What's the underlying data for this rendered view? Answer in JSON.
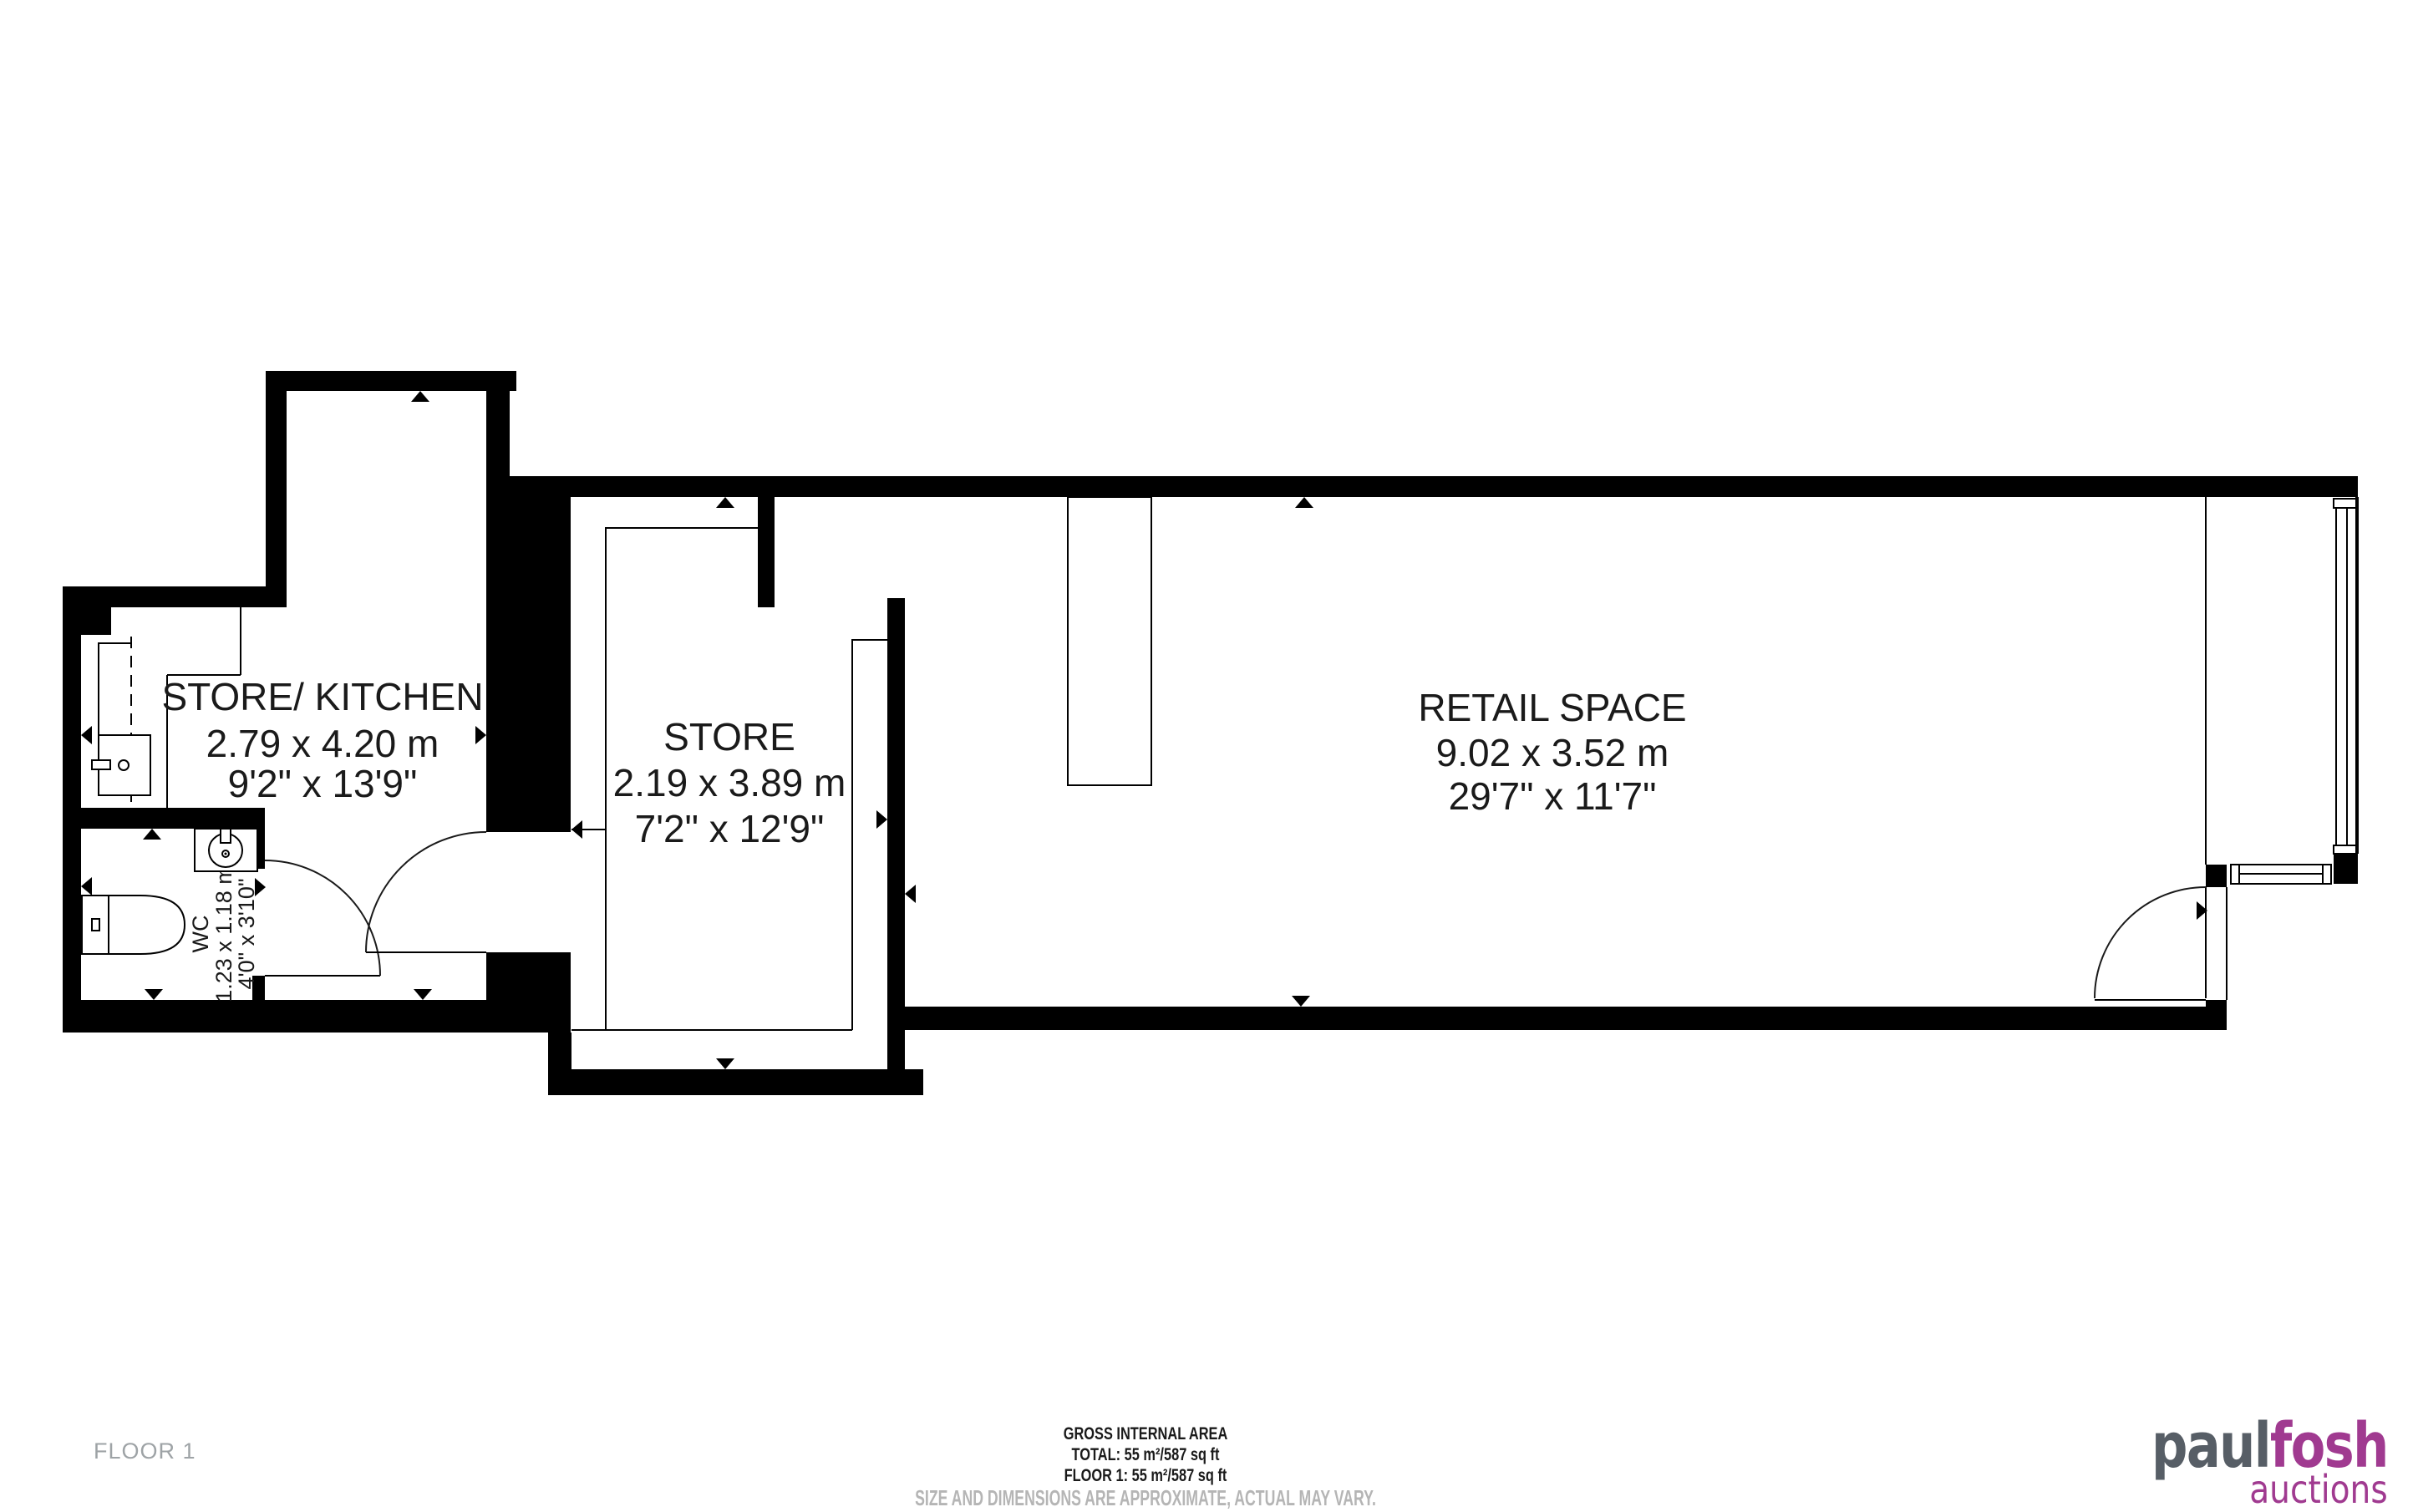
{
  "rooms": {
    "kitchen": {
      "name": "STORE/ KITCHEN",
      "metric": "2.79 x 4.20 m",
      "imperial": "9'2\" x 13'9\""
    },
    "store": {
      "name": "STORE",
      "metric": "2.19 x 3.89 m",
      "imperial": "7'2\" x 12'9\""
    },
    "retail": {
      "name": "RETAIL SPACE",
      "metric": "9.02 x 3.52 m",
      "imperial": "29'7\" x 11'7\""
    },
    "wc": {
      "name": "WC",
      "metric": "1.23 x 1.18 m",
      "imperial": "4'0\" x 3'10\""
    }
  },
  "floor_label": "FLOOR 1",
  "footer": {
    "line1": "GROSS INTERNAL AREA",
    "line2": "TOTAL: 55 m²/587 sq ft",
    "line3": "FLOOR 1: 55 m²/587 sq ft",
    "line4": "SIZE AND DIMENSIONS ARE APPROXIMATE, ACTUAL MAY VARY."
  },
  "logo": {
    "part1": "paul",
    "part2": "fosh",
    "tagline": "auctions",
    "color_dark": "#575e66",
    "color_purple": "#a03a90"
  },
  "colors": {
    "walls": "#000000",
    "muted_text": "#9ea3a6",
    "disclaimer_text": "#b5b5b5"
  }
}
